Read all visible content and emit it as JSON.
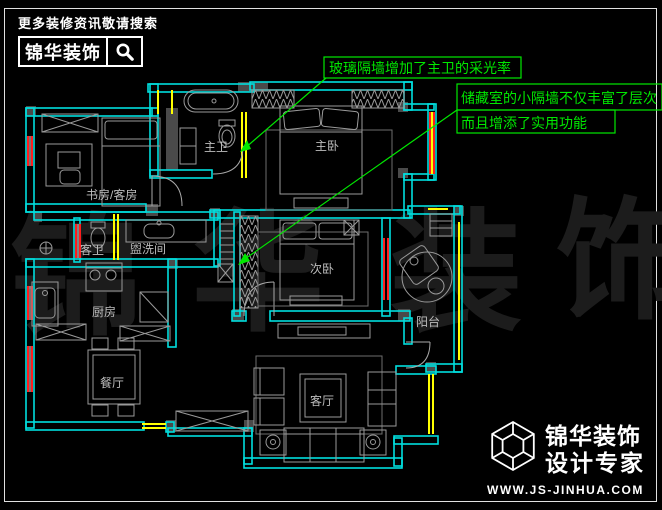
{
  "header": {
    "tagline": "更多装修资讯敬请搜索",
    "brand": "锦华装饰"
  },
  "callouts": {
    "glass_partition": "玻璃隔墙增加了主卫的采光率",
    "storage_line1": "储藏室的小隔墙不仅丰富了层次",
    "storage_line2": "而且增添了实用功能"
  },
  "rooms": {
    "master_bath": "主卫",
    "master_bedroom": "主卧",
    "study": "书房/客房",
    "guest_bath": "客卫",
    "washroom": "盥洗间",
    "second_bedroom": "次卧",
    "kitchen": "厨房",
    "dining": "餐厅",
    "balcony": "阳台",
    "living": "客厅"
  },
  "watermark": {
    "chars": [
      "锦",
      "华",
      "装",
      "饰"
    ]
  },
  "footer": {
    "brand": "锦华装饰",
    "subtitle": "设计专家",
    "website": "WWW.JS-JINHUA.COM"
  },
  "colors": {
    "background": "#000000",
    "wall": "#00dede",
    "window_red": "#ff1d1d",
    "glass_yellow": "#ffff00",
    "annotation_green": "#00e800",
    "furniture_gray": "#9a9a9a",
    "label_gray": "#bdbdbd",
    "logo_white": "#ffffff"
  }
}
